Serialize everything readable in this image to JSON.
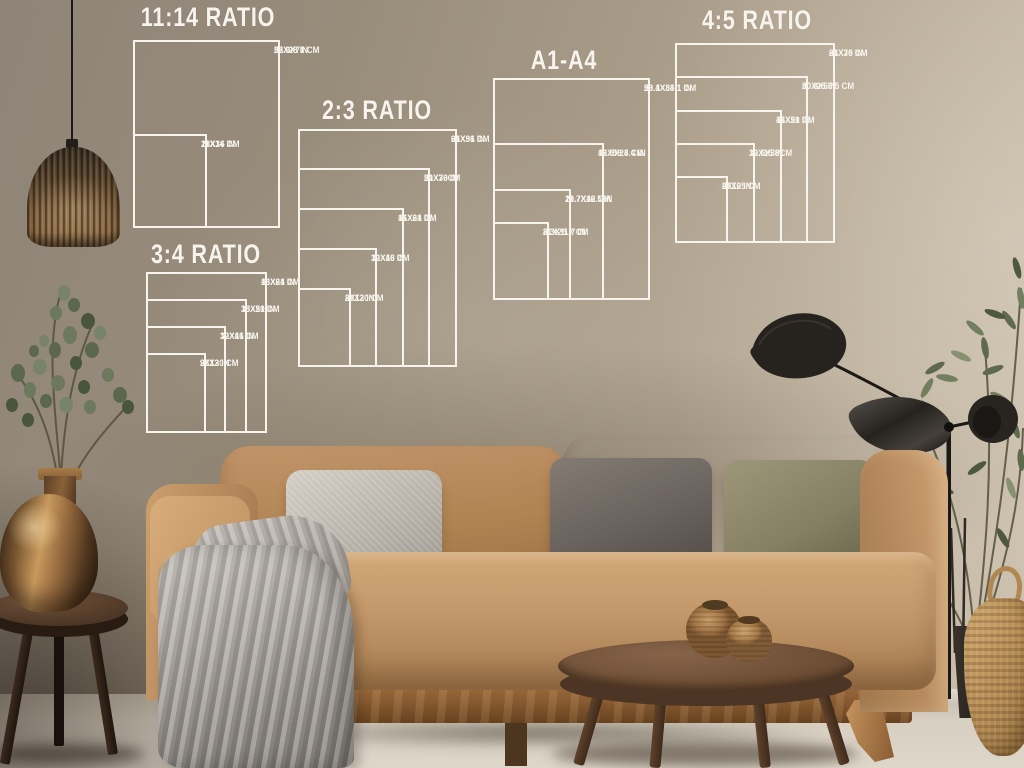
{
  "size_guide": {
    "line_color": "#f7f4ed",
    "units_note": "white outline boxes on wall, nested bottom-left, label at top-right of each box",
    "groups": [
      {
        "id": "ratio-11-14",
        "title": "11:14 RATIO",
        "title_x": 208,
        "title_y": 2,
        "left": 133,
        "bottom": 228,
        "scale": 6.7,
        "sizes": [
          {
            "w": 22,
            "h": 28,
            "in": "22X28 IN",
            "cm": "55.9X71 CM"
          },
          {
            "w": 11,
            "h": 14,
            "in": "11X14 IN",
            "cm": "28X36 CM"
          }
        ]
      },
      {
        "id": "ratio-3-4",
        "title": "3:4 RATIO",
        "title_x": 206,
        "title_y": 239,
        "left": 146,
        "bottom": 433,
        "scale": 6.7,
        "sizes": [
          {
            "w": 18,
            "h": 24,
            "in": "18X24 IN",
            "cm": "46X61 CM"
          },
          {
            "w": 15,
            "h": 20,
            "in": "15X20 IN",
            "cm": "38X51 CM"
          },
          {
            "w": 12,
            "h": 16,
            "in": "12X16 IN",
            "cm": "30X41 CM"
          },
          {
            "w": 9,
            "h": 12,
            "in": "9X12 IN",
            "cm": "23X30 CM"
          }
        ]
      },
      {
        "id": "ratio-2-3",
        "title": "2:3 RATIO",
        "title_x": 377,
        "title_y": 95,
        "left": 298,
        "bottom": 367,
        "scale": 6.62,
        "sizes": [
          {
            "w": 24,
            "h": 36,
            "in": "24X36 IN",
            "cm": "61X91 CM"
          },
          {
            "w": 20,
            "h": 30,
            "in": "20X30 IN",
            "cm": "51X76CM"
          },
          {
            "w": 16,
            "h": 24,
            "in": "16X24 IN",
            "cm": "41X61 CM"
          },
          {
            "w": 12,
            "h": 18,
            "in": "12X18 IN",
            "cm": "30X46 CM"
          },
          {
            "w": 8,
            "h": 12,
            "in": "8X12 IN",
            "cm": "20X30 CM"
          }
        ]
      },
      {
        "id": "a1-a4",
        "title": "A1-A4",
        "title_x": 564,
        "title_y": 45,
        "left": 493,
        "bottom": 300,
        "scale": 6.7,
        "sizes": [
          {
            "w": 23.4,
            "h": 33.1,
            "in": "23.4X33.1 IN",
            "cm": "59.1X84.1 CM"
          },
          {
            "w": 16.5,
            "h": 23.4,
            "in": "16.5X23.4 IN",
            "cm": "42X59.4 CM"
          },
          {
            "w": 11.7,
            "h": 16.5,
            "in": "11.7X16.5 IN",
            "cm": "29.7X42 CM"
          },
          {
            "w": 8.3,
            "h": 11.7,
            "in": "8.3X11.7 IN",
            "cm": "21X29.7 CM"
          }
        ]
      },
      {
        "id": "ratio-4-5",
        "title": "4:5 RATIO",
        "title_x": 757,
        "title_y": 5,
        "left": 675,
        "bottom": 243,
        "scale": 6.67,
        "sizes": [
          {
            "w": 24,
            "h": 30,
            "in": "24X30 IN",
            "cm": "61X76 CM"
          },
          {
            "w": 20,
            "h": 25,
            "in": "20X25 IN",
            "cm": "50.8X63.5 CM"
          },
          {
            "w": 16,
            "h": 20,
            "in": "16X20 IN",
            "cm": "41X51 CM"
          },
          {
            "w": 12,
            "h": 15,
            "in": "12X15 IN",
            "cm": "30.5X38CM"
          },
          {
            "w": 8,
            "h": 10,
            "in": "8X10 IN",
            "cm": "20X25 CM"
          }
        ]
      }
    ]
  },
  "palette": {
    "wall": "#a2957f",
    "wall_light": "#c9bdab",
    "wall_dark": "#3f362a",
    "guide_line": "#f7f4ed",
    "sofa": "#bf9263",
    "sofa_dark": "#a0744a",
    "wood_rail": "#8a5c33",
    "pillow_gray_light": "#bdb8b0",
    "pillow_gray_dark": "#6e6761",
    "pillow_olive": "#8a856a",
    "blanket": "#a39e98",
    "table_wood": "#6e4e35",
    "stool_wood": "#4a3525",
    "vase_copper": "#a97a48",
    "basket": "#c29c64",
    "lamp_black": "#24201c",
    "plant_green": "#6f7a5e",
    "floor": "#d8d0c3"
  }
}
